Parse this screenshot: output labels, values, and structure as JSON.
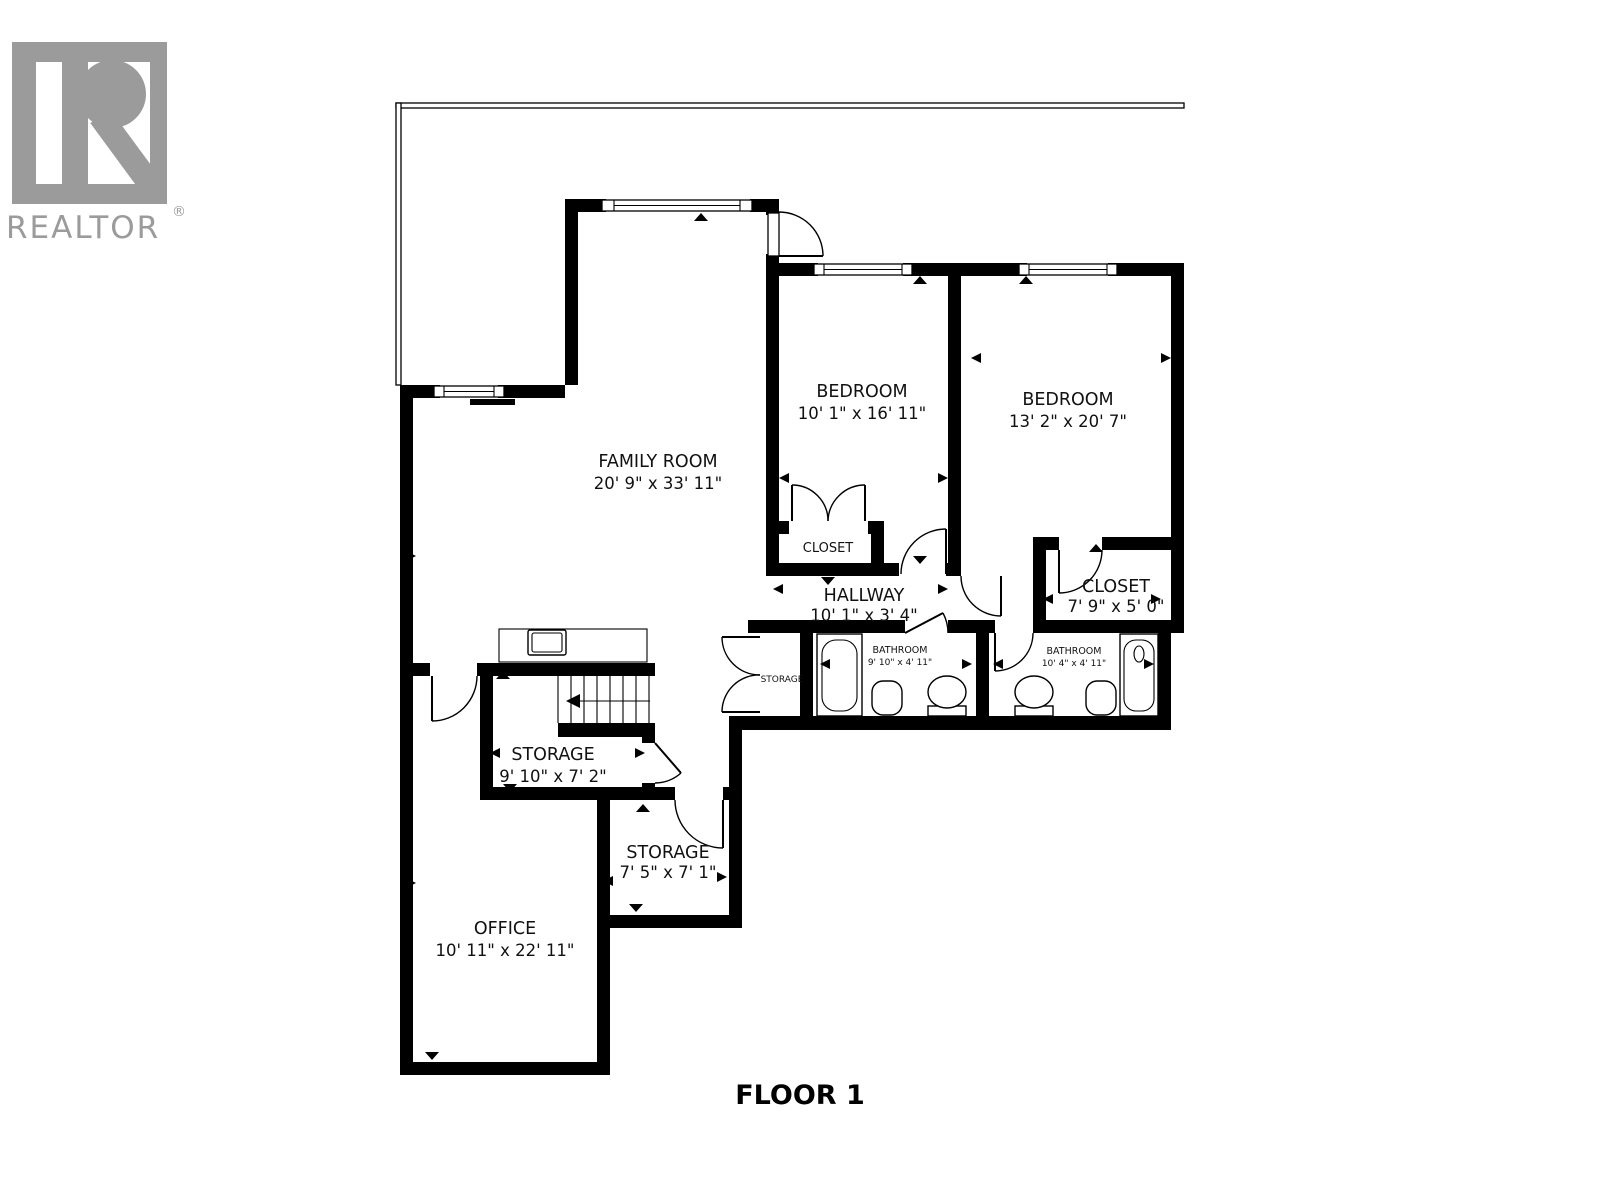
{
  "branding": {
    "logo_text": "REALTOR",
    "registered_mark": "®",
    "logo_color": "#9b9b9b"
  },
  "floor_title": "FLOOR 1",
  "rooms": [
    {
      "name": "FAMILY ROOM",
      "dims": "20' 9\" x 33' 11\""
    },
    {
      "name": "BEDROOM",
      "dims": "10' 1\" x 16' 11\""
    },
    {
      "name": "BEDROOM",
      "dims": "13' 2\" x 20' 7\""
    },
    {
      "name": "CLOSET",
      "dims": ""
    },
    {
      "name": "HALLWAY",
      "dims": "10' 1\" x 3' 4\""
    },
    {
      "name": "CLOSET",
      "dims": "7' 9\" x 5' 0\""
    },
    {
      "name": "BATHROOM",
      "dims": "9' 10\" x 4' 11\""
    },
    {
      "name": "BATHROOM",
      "dims": "10' 4\" x 4' 11\""
    },
    {
      "name": "STORAGE",
      "dims": ""
    },
    {
      "name": "STORAGE",
      "dims": "9' 10\" x 7' 2\""
    },
    {
      "name": "STORAGE",
      "dims": "7' 5\" x 7' 1\""
    },
    {
      "name": "OFFICE",
      "dims": "10' 11\" x 22' 11\""
    }
  ]
}
